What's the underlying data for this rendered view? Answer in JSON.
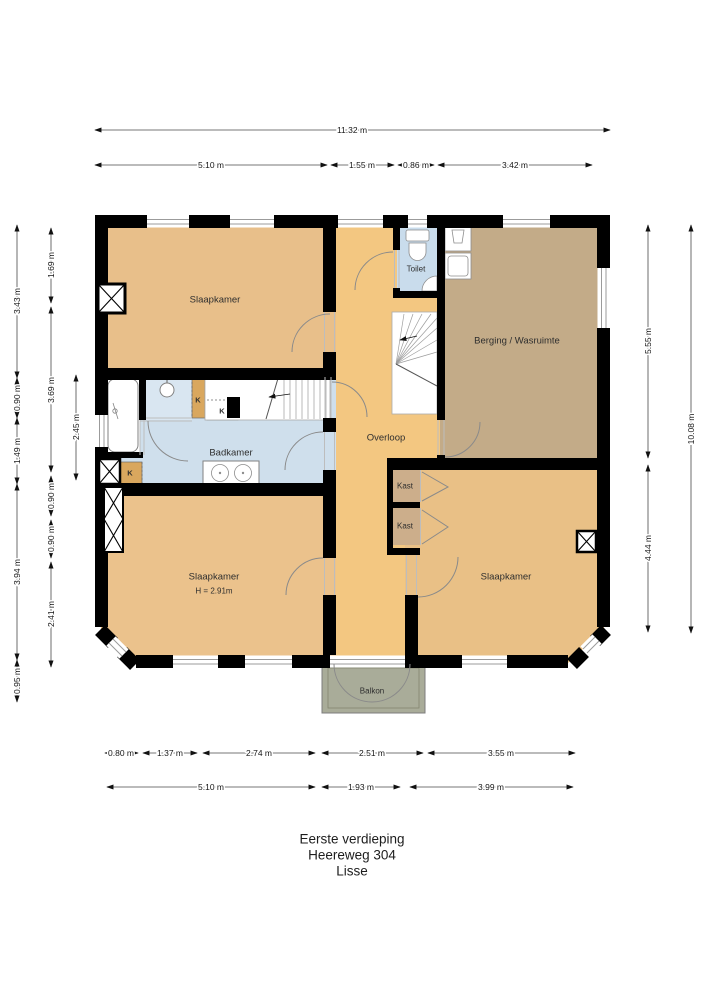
{
  "title": {
    "line1": "Eerste verdieping",
    "line2": "Heereweg 304",
    "line3": "Lisse"
  },
  "rooms": {
    "slaapkamer_top": "Slaapkamer",
    "badkamer": "Badkamer",
    "toilet": "Toilet",
    "overloop": "Overloop",
    "berging": "Berging / Wasruimte",
    "slaapkamer_links": "Slaapkamer",
    "slaapkamer_links_hoogte": "H = 2.91m",
    "slaapkamer_rechts": "Slaapkamer",
    "kast1": "Kast",
    "kast2": "Kast",
    "k1": "K",
    "k2": "K",
    "k3": "K",
    "balkon": "Balkon"
  },
  "dimensions": {
    "top_total": "11.32 m",
    "top": [
      "5.10 m",
      "1.55 m",
      "0.86 m",
      "3.42 m"
    ],
    "bottom_detail": [
      "0.80 m",
      "1.37 m",
      "2.74 m",
      "2.51 m",
      "3.55 m"
    ],
    "bottom": [
      "5.10 m",
      "1.93 m",
      "3.99 m"
    ],
    "left_outer": [
      "3.43 m",
      "0.90 m",
      "1.49 m",
      "3.94 m",
      "0.95 m"
    ],
    "left_inner": [
      "1.69 m",
      "3.69 m",
      "0.90 m",
      "0.90 m",
      "2.41 m"
    ],
    "left_inner2": "2.45 m",
    "right_inner": [
      "5.55 m",
      "4.44 m"
    ],
    "right_total": "10.08 m"
  },
  "colors": {
    "room_orange": "#e8bf8a",
    "hall_orange": "#f3c781",
    "storage_tan": "#c3ab88",
    "closet_tan": "#ccae8b",
    "small_closet_orange": "#d9a75e",
    "bath_blue": "#cfdfec",
    "shower_blue": "#d9e6f1",
    "balcony_green": "#a9ac99",
    "wall_black": "#000000"
  }
}
